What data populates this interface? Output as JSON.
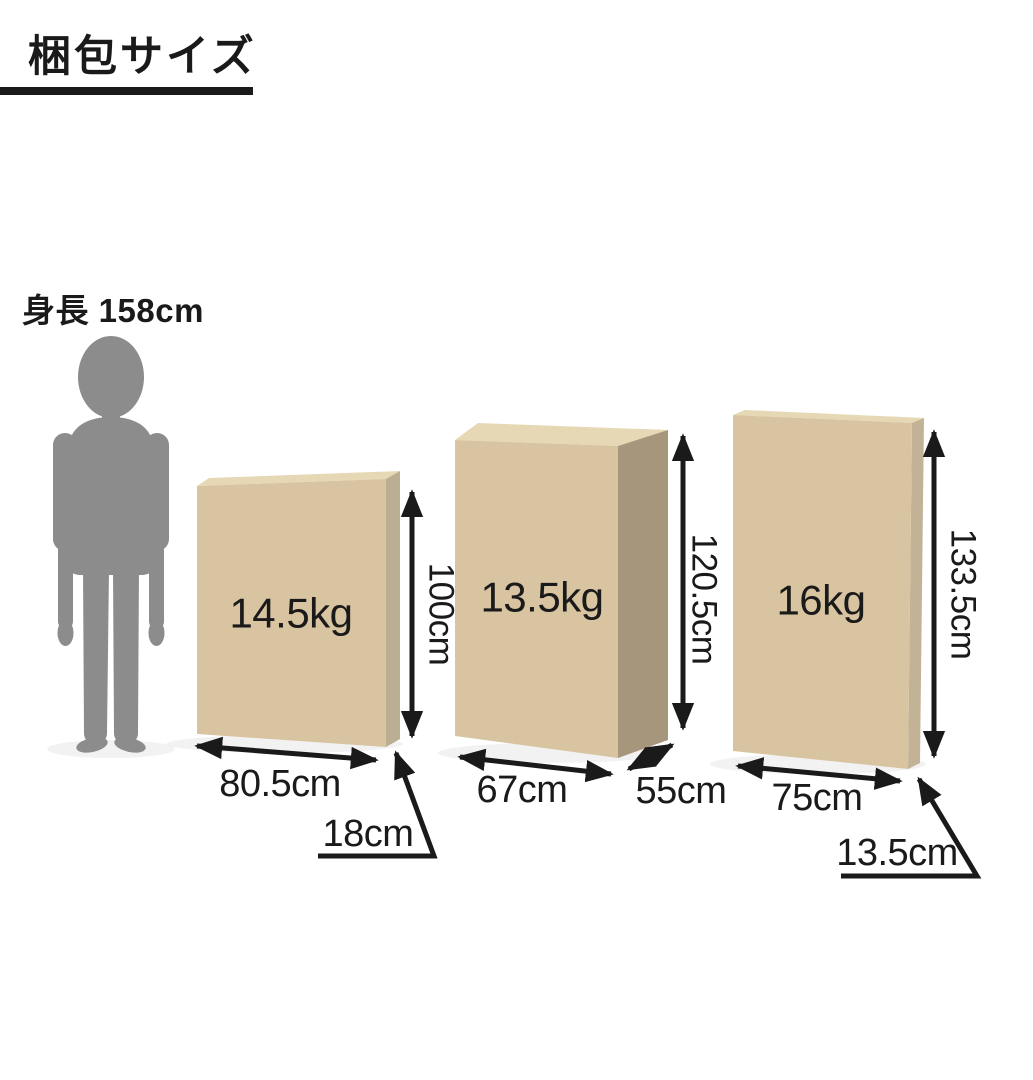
{
  "title": "梱包サイズ",
  "person": {
    "height_label": "身長 158cm",
    "height_cm": 158
  },
  "boxes": [
    {
      "weight_label": "14.5kg",
      "weight_kg": 14.5,
      "width_label": "80.5cm",
      "width_cm": 80.5,
      "height_label": "100cm",
      "height_cm": 100,
      "depth_label": "18cm",
      "depth_cm": 18
    },
    {
      "weight_label": "13.5kg",
      "weight_kg": 13.5,
      "width_label": "67cm",
      "width_cm": 67,
      "height_label": "120.5cm",
      "height_cm": 120.5,
      "depth_label": "55cm",
      "depth_cm": 55
    },
    {
      "weight_label": "16kg",
      "weight_kg": 16,
      "width_label": "75cm",
      "width_cm": 75,
      "height_label": "133.5cm",
      "height_cm": 133.5,
      "depth_label": "13.5cm",
      "depth_cm": 13.5
    }
  ],
  "colors": {
    "ink": "#1a1a1a",
    "silhouette": "#8c8c8c",
    "box_front": "#d8c4a0",
    "box_top": "#e7d8b5",
    "box1_side": "#bcae92",
    "box2_side": "#a5967c",
    "box3_side": "#c3b396",
    "background": "#ffffff"
  }
}
